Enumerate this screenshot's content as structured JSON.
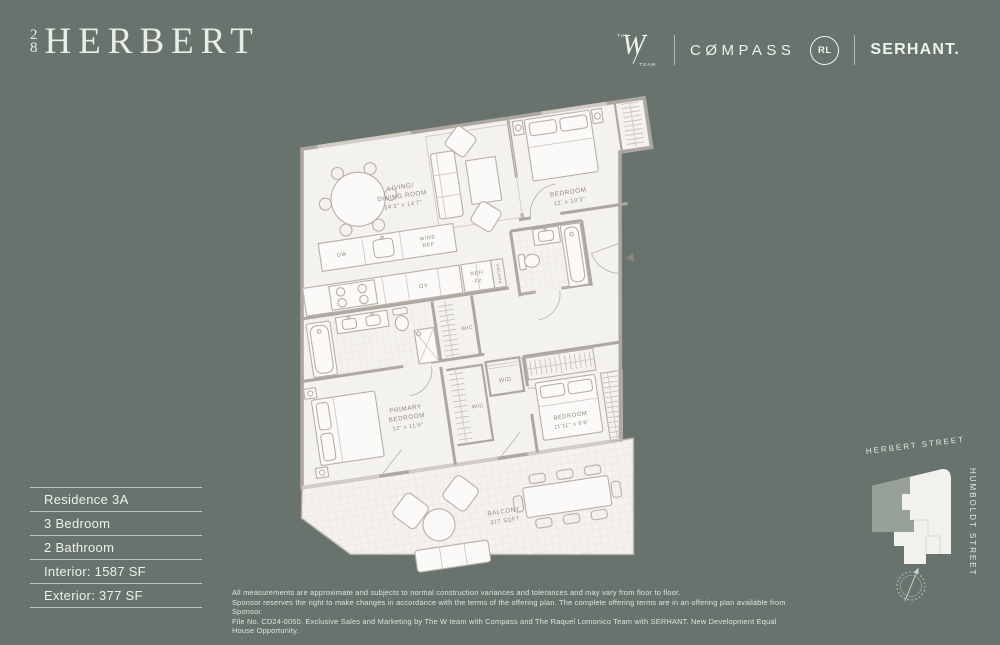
{
  "header": {
    "logo": {
      "top_digit": "2",
      "bottom_digit": "8",
      "name": "HERBERT"
    },
    "partners": {
      "the": "THE",
      "w": "W",
      "team": "TEAM",
      "compass": "CØMPASS",
      "rl_monogram": "RL",
      "serhant": "SERHANT."
    }
  },
  "info_panel": {
    "rows": [
      "Residence 3A",
      "3 Bedroom",
      "2 Bathroom",
      "Interior: 1587 SF",
      "Exterior: 377 SF"
    ]
  },
  "floorplan": {
    "living": [
      "LIVING/",
      "DINING ROOM",
      "24'3\" x 14'7\""
    ],
    "bedroom1": [
      "BEDROOM",
      "12' x 10'3\""
    ],
    "kitchen": [
      "KITCHEN",
      "8'7\" x 14'5\""
    ],
    "primary": [
      "PRIMARY",
      "BEDROOM",
      "12' x 11'6\""
    ],
    "bedroom2": [
      "BEDROOM",
      "11'11\" x 9'8\""
    ],
    "balcony": [
      "BALCONY",
      "377 SQFT"
    ],
    "appliances": {
      "dw": "DW",
      "wine1": "WINE",
      "wine2": "REF",
      "ov": "OV",
      "ref1": "REF/",
      "ref2": "FZ",
      "pantry": "PANTRY",
      "wd": "W/D",
      "wic": "WIC"
    }
  },
  "site_map": {
    "street_top": "HERBERT STREET",
    "street_side": "HUMBOLDT STREET"
  },
  "disclaimer": [
    "All measurements are approximate and subjects to normal construction variances and tolerances and may vary from floor to floor.",
    "Sponsor reserves the right to make changes in accordance with the terms of the offering plan. The complete offering terms are in an offering plan available from Sponsor.",
    "File No. CD24-0050. Exclusive Sales and Marketing by The W team with Compass and The Raquel Lomonico Team with SERHANT. New Development Equal House Opportunity."
  ],
  "colors": {
    "background": "#67736c",
    "floor": "#f4f2ee",
    "wall": "#ada79f",
    "text_light": "#eef1ec"
  }
}
